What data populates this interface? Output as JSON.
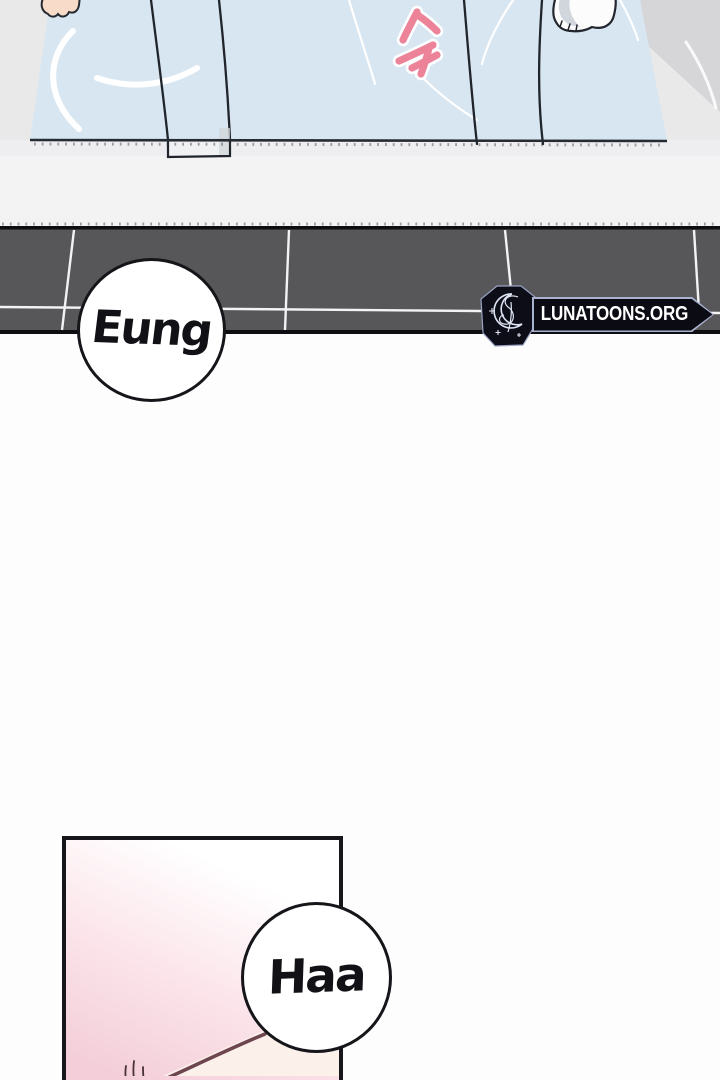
{
  "bubbles": {
    "eung": "Eung",
    "haa": "Haa"
  },
  "watermark": {
    "text": "LUNATOONS.ORG"
  },
  "sfx": {
    "korean": "슥",
    "style": "hand-drawn pink strokes with white outline"
  },
  "colors": {
    "page_bg": "#fdfdfd",
    "wall_gray": "#e9e9ea",
    "wall_dark": "#d6d6d9",
    "floor_gray": "#f3f3f4",
    "blanket_blue": "#d8e6f1",
    "ink": "#20242b",
    "sheen_white": "#ffffff",
    "tile_gray": "#57575a",
    "tile_border": "#0e0e12",
    "grout_white": "#f3f3f4",
    "sfx_pink": "#ec8398",
    "skin": "#f8dcc9",
    "bubble_border": "#15151a",
    "bubble_fill": "#ffffff",
    "badge_dark": "#0b0b13",
    "badge_outline": "#a9b2cf",
    "panel_border": "#17171b",
    "panel_pink": "#f4cfd9",
    "panel_light": "#fbf0ea",
    "maroon": "#6e4650"
  }
}
